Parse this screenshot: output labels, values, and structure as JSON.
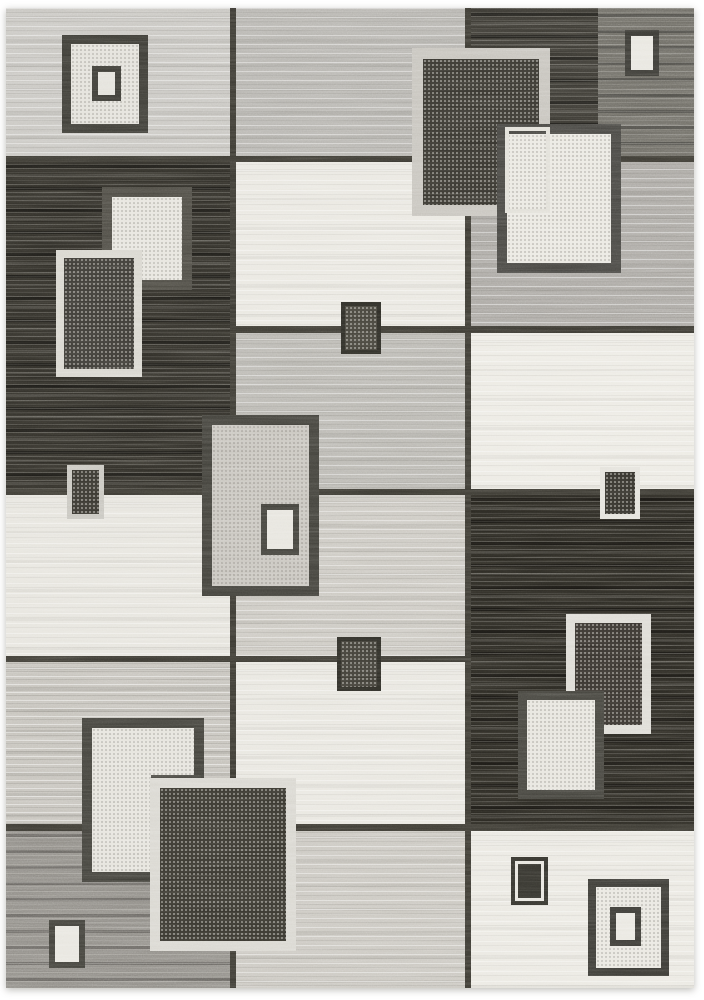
{
  "scene": {
    "type": "product-photograph",
    "subject": "modern geometric patchwork area rug, grey / charcoal / ivory blocks with overlapping square motifs",
    "background": "white studio backdrop"
  },
  "palette": {
    "page_background": "#ffffff",
    "seam": "#3a3831",
    "black_pile": "#2a2822",
    "charcoal_pile": "#37352f",
    "ivory_pile": "#e9e7e0",
    "light_gray_pile": "#c7c5c0",
    "medium_gray_pile": "#b1afaa",
    "greige_pile": "#c4c1ba",
    "dark_gray_pile": "#8d8a84",
    "dark_frame": "#3f3e38",
    "light_frame": "#d8d6cf"
  },
  "rug": {
    "x": 6,
    "y": 8,
    "w": 688,
    "h": 980
  },
  "patches": [
    {
      "name": "patch-left-top-lightgray",
      "x": 6,
      "y": 8,
      "w": 227,
      "h": 152,
      "color": "#c7c5c0",
      "texture": "b"
    },
    {
      "name": "patch-left-black",
      "x": 6,
      "y": 160,
      "w": 227,
      "h": 333,
      "color": "#2e2c26",
      "texture": "d"
    },
    {
      "name": "patch-left-ivory",
      "x": 6,
      "y": 493,
      "w": 227,
      "h": 167,
      "color": "#e6e4dd",
      "texture": "a"
    },
    {
      "name": "patch-left-greige",
      "x": 6,
      "y": 660,
      "w": 227,
      "h": 168,
      "color": "#c4c1ba",
      "texture": "c"
    },
    {
      "name": "patch-left-darkgray",
      "x": 6,
      "y": 828,
      "w": 227,
      "h": 160,
      "color": "#8d8a84",
      "texture": "e"
    },
    {
      "name": "patch-mid-gray",
      "x": 233,
      "y": 8,
      "w": 235,
      "h": 152,
      "color": "#b5b3ae",
      "texture": "b"
    },
    {
      "name": "patch-mid-ivory-upper",
      "x": 233,
      "y": 160,
      "w": 235,
      "h": 170,
      "color": "#e9e7e0",
      "texture": "a"
    },
    {
      "name": "patch-mid-gray-2",
      "x": 233,
      "y": 330,
      "w": 235,
      "h": 163,
      "color": "#b8b6b0",
      "texture": "b"
    },
    {
      "name": "patch-mid-greige",
      "x": 233,
      "y": 493,
      "w": 235,
      "h": 167,
      "color": "#cac7c0",
      "texture": "b"
    },
    {
      "name": "patch-mid-ivory-lower",
      "x": 233,
      "y": 660,
      "w": 235,
      "h": 168,
      "color": "#e8e6df",
      "texture": "a"
    },
    {
      "name": "patch-mid-lightgray-bottom",
      "x": 233,
      "y": 828,
      "w": 235,
      "h": 160,
      "color": "#c9c6bf",
      "texture": "b"
    },
    {
      "name": "patch-right-charcoal-top",
      "x": 468,
      "y": 8,
      "w": 226,
      "h": 152,
      "color": "#37352f",
      "texture": "d"
    },
    {
      "name": "patch-right-gray-corner",
      "x": 598,
      "y": 8,
      "w": 96,
      "h": 152,
      "color": "#6b6962",
      "texture": "e"
    },
    {
      "name": "patch-right-gray-band",
      "x": 468,
      "y": 160,
      "w": 226,
      "h": 171,
      "color": "#a9a6a1",
      "texture": "b"
    },
    {
      "name": "patch-right-ivory-band",
      "x": 468,
      "y": 331,
      "w": 226,
      "h": 162,
      "color": "#eceae3",
      "texture": "a"
    },
    {
      "name": "patch-right-black",
      "x": 468,
      "y": 493,
      "w": 226,
      "h": 338,
      "color": "#282620",
      "texture": "d"
    },
    {
      "name": "patch-right-ivory-bottom",
      "x": 468,
      "y": 831,
      "w": 226,
      "h": 157,
      "color": "#eae8e1",
      "texture": "a"
    }
  ],
  "seams": [
    {
      "name": "seam-vertical-1",
      "x": 230,
      "y": 8,
      "w": 6,
      "h": 980
    },
    {
      "name": "seam-vertical-2",
      "x": 465,
      "y": 8,
      "w": 6,
      "h": 980
    },
    {
      "name": "seam-horizontal-1",
      "x": 6,
      "y": 156,
      "w": 688,
      "h": 6
    },
    {
      "name": "seam-horizontal-2",
      "x": 233,
      "y": 326,
      "w": 461,
      "h": 7
    },
    {
      "name": "seam-horizontal-3",
      "x": 6,
      "y": 489,
      "w": 688,
      "h": 6
    },
    {
      "name": "seam-horizontal-4",
      "x": 6,
      "y": 656,
      "w": 462,
      "h": 6
    },
    {
      "name": "seam-horizontal-5",
      "x": 6,
      "y": 824,
      "w": 688,
      "h": 7
    }
  ],
  "ornaments": [
    {
      "name": "motif-nested-square-outer-tl",
      "x": 62,
      "y": 35,
      "w": 86,
      "h": 98,
      "border": 9,
      "borderColor": "#3b3a34",
      "fill": "#e3e1da",
      "speckle": "dark"
    },
    {
      "name": "motif-nested-square-inner-tl",
      "x": 92,
      "y": 66,
      "w": 29,
      "h": 35,
      "border": 6,
      "borderColor": "#3b3a34",
      "fill": "#e3e1da"
    },
    {
      "name": "motif-ivory-box-left",
      "x": 102,
      "y": 187,
      "w": 90,
      "h": 103,
      "border": 10,
      "borderColor": "#4b4942",
      "fill": "#e6e4dd",
      "speckle": "dark"
    },
    {
      "name": "motif-outline-square-left",
      "x": 56,
      "y": 250,
      "w": 86,
      "h": 127,
      "border": 8,
      "borderColor": "#d7d5cd",
      "fill": "#383631",
      "speckle": "light"
    },
    {
      "name": "motif-bordered-rect-left",
      "x": 67,
      "y": 465,
      "w": 37,
      "h": 54,
      "border": 5,
      "borderColor": "#c6c4bd",
      "fill": "#33312b",
      "speckle": "light"
    },
    {
      "name": "motif-small-square-mid-upper",
      "x": 341,
      "y": 302,
      "w": 40,
      "h": 52,
      "border": 4,
      "borderColor": "#2b2a24",
      "fill": "#413f37",
      "speckle": "light"
    },
    {
      "name": "motif-big-framed-box-center",
      "x": 202,
      "y": 415,
      "w": 117,
      "h": 181,
      "border": 10,
      "borderColor": "#403f39",
      "fill": "#c7c4bd",
      "speckle": "dark"
    },
    {
      "name": "motif-inner-ivory-rect-center",
      "x": 261,
      "y": 504,
      "w": 38,
      "h": 51,
      "border": 6,
      "borderColor": "#403f39",
      "fill": "#e6e4dd"
    },
    {
      "name": "motif-small-square-mid-lower",
      "x": 337,
      "y": 637,
      "w": 44,
      "h": 54,
      "border": 4,
      "borderColor": "#2b2a24",
      "fill": "#3b3932",
      "speckle": "light"
    },
    {
      "name": "motif-light-framed-box-tr",
      "x": 412,
      "y": 48,
      "w": 138,
      "h": 168,
      "border": 11,
      "borderColor": "#c5c2bb",
      "fill": "#34322c",
      "speckle": "light"
    },
    {
      "name": "motif-ivory-box-tr",
      "x": 497,
      "y": 124,
      "w": 124,
      "h": 149,
      "border": 10,
      "borderColor": "#454440",
      "fill": "#eae8e1",
      "speckle": "dark"
    },
    {
      "name": "motif-outline-rect-tr",
      "x": 505,
      "y": 127,
      "w": 45,
      "h": 86,
      "border": 4,
      "borderColor": "#e0ded6",
      "fill": "transparent"
    },
    {
      "name": "motif-small-ivory-rect-tr",
      "x": 625,
      "y": 30,
      "w": 34,
      "h": 46,
      "border": 6,
      "borderColor": "#3a3934",
      "fill": "#e8e6df"
    },
    {
      "name": "motif-bordered-rect-right",
      "x": 600,
      "y": 467,
      "w": 40,
      "h": 52,
      "border": 5,
      "borderColor": "#e3e1da",
      "fill": "#302e28",
      "speckle": "light"
    },
    {
      "name": "motif-light-framed-box-right",
      "x": 566,
      "y": 614,
      "w": 85,
      "h": 120,
      "border": 9,
      "borderColor": "#dcdad3",
      "fill": "#332f2a",
      "speckle": "light"
    },
    {
      "name": "motif-ivory-box-right",
      "x": 518,
      "y": 691,
      "w": 86,
      "h": 108,
      "border": 9,
      "borderColor": "#43423c",
      "fill": "#e7e5de",
      "speckle": "dark"
    },
    {
      "name": "motif-dark-framed-box-bl",
      "x": 82,
      "y": 718,
      "w": 122,
      "h": 164,
      "border": 10,
      "borderColor": "#403f39",
      "fill": "#e5e3dc",
      "speckle": "dark"
    },
    {
      "name": "motif-outline-rect-bl",
      "x": 151,
      "y": 775,
      "w": 50,
      "h": 109,
      "border": 5,
      "borderColor": "#45443e",
      "fill": "transparent"
    },
    {
      "name": "motif-charcoal-box-bl",
      "x": 150,
      "y": 778,
      "w": 146,
      "h": 173,
      "border": 10,
      "borderColor": "#d8d6cf",
      "fill": "#34322b",
      "speckle": "light"
    },
    {
      "name": "motif-small-ivory-rect-bl",
      "x": 49,
      "y": 920,
      "w": 36,
      "h": 48,
      "border": 6,
      "borderColor": "#3f3e38",
      "fill": "#e7e5de"
    },
    {
      "name": "motif-small-dark-rect-bottom",
      "x": 511,
      "y": 857,
      "w": 37,
      "h": 48,
      "border": 4,
      "borderColor": "#32312b",
      "fill": "#32312b",
      "inset": "#e6e4dd"
    },
    {
      "name": "motif-nested-square-outer-br",
      "x": 588,
      "y": 879,
      "w": 81,
      "h": 97,
      "border": 8,
      "borderColor": "#3a3934",
      "fill": "#e9e7e0",
      "speckle": "dark"
    },
    {
      "name": "motif-nested-square-inner-br",
      "x": 610,
      "y": 907,
      "w": 31,
      "h": 39,
      "border": 6,
      "borderColor": "#3a3934",
      "fill": "#e9e7e0"
    }
  ]
}
